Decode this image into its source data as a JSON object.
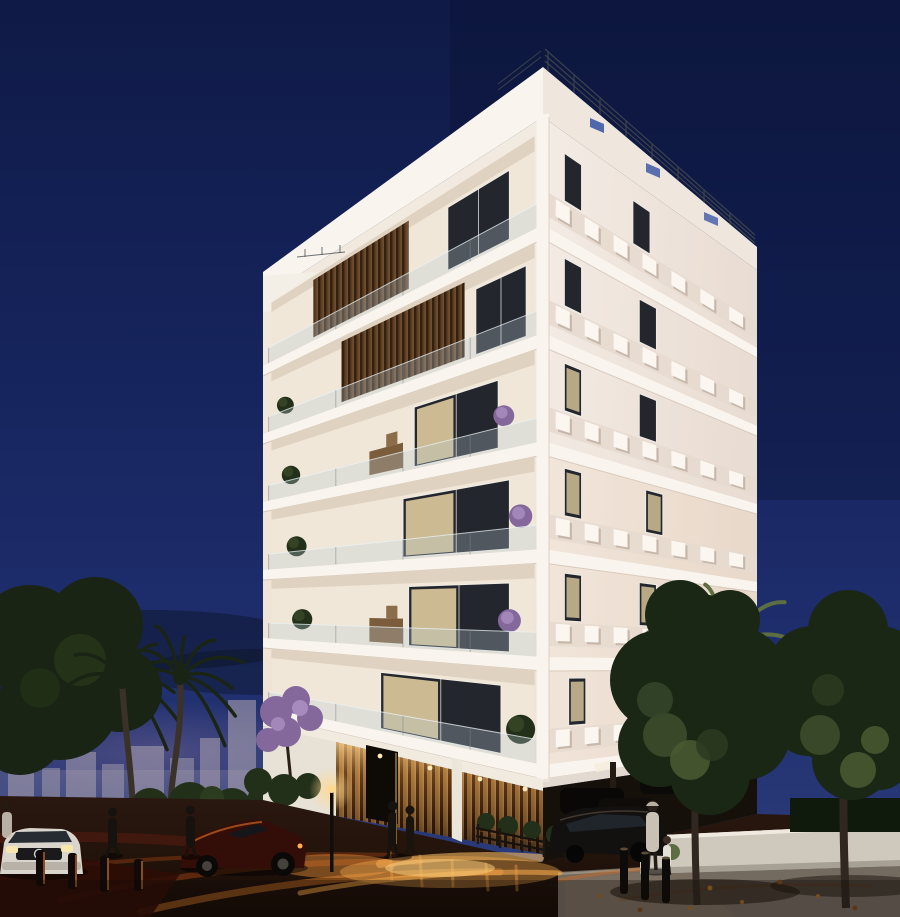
{
  "image": {
    "type": "3d-architectural-night-rendering",
    "subject": "modern white corner apartment building at dusk with lit balconies, palm trees, street life and warm street-light reflections"
  },
  "palette": {
    "sky_top": "#0f1a46",
    "sky_mid": "#16245d",
    "sky_low": "#1f2e6e",
    "sky_horizon": "#2e3e7c",
    "cloud_dark": "#0a1424",
    "horizon_glow": "#7c6a94",
    "skyline_haze": "#b5aab4",
    "facade_left": "#f2ebe1",
    "facade_right_near": "#f3ece5",
    "facade_right_far": "#e9dcd2",
    "slab_white": "#f9f5ee",
    "balcony_interior": "#f0e7d8",
    "balcony_ceiling": "#dccdbb",
    "parapet_band": "#e6d9cf",
    "perf_square": "#fbf7f0",
    "window_dark": "#23262d",
    "window_lit": "#e9d5a4",
    "window_frame": "#efece5",
    "wood_dark": "#33200f",
    "wood_mid": "#5a3d24",
    "wood_light": "#7a5835",
    "lobby_wood": "#9a6c38",
    "glass_railing": "#bac9d5",
    "plant_dark": "#22301a",
    "plant_light": "#41542c",
    "purple_plant": "#84689c",
    "tree_dark": "#1b2715",
    "tree_mid": "#2c3b20",
    "tree_light": "#495a31",
    "palm_dark": "#1a2415",
    "palm_lit": "#5d6e42",
    "trunk": "#3a3129",
    "street_dark": "#1d110a",
    "street_maroon": "#2e0d06",
    "orange_deep": "#8f3c10",
    "orange_mid": "#cf6a22",
    "orange_bright": "#f0a445",
    "amber": "#ffd382",
    "lamp_light": "#ffd98f",
    "pavement": "#736a60",
    "wall_white": "#cfc8bd",
    "car_white": "#d9d4cc",
    "car_dark": "#131010",
    "car_red": "#330e08",
    "figure_dark": "#16120d",
    "coat_light": "#c9c1b4",
    "sky_glimpse": "#3d5aa6"
  },
  "building": {
    "floors_visible": 6,
    "has_roof_railing": true,
    "ground_floor": {
      "material": "lit-wood-slats",
      "entrance": true,
      "covered_parking": true
    },
    "left_floors": [
      {
        "doors": [
          [
            0.12,
            0.34,
            false
          ]
        ],
        "wood": [
          0.48,
          0.82
        ],
        "bush": null,
        "purple": null,
        "furniture": false
      },
      {
        "doors": [
          [
            0.06,
            0.24,
            false
          ]
        ],
        "wood": [
          0.28,
          0.72
        ],
        "bush": {
          "u": 0.92,
          "r": 13
        },
        "purple": null,
        "furniture": false
      },
      {
        "doors": [
          [
            0.16,
            0.46,
            true
          ]
        ],
        "wood": null,
        "bush": {
          "u": 0.9,
          "r": 14
        },
        "purple": {
          "u": 0.14,
          "r": 11
        },
        "furniture": true
      },
      {
        "doors": [
          [
            0.12,
            0.5,
            true
          ]
        ],
        "wood": null,
        "bush": {
          "u": 0.88,
          "r": 15
        },
        "purple": {
          "u": 0.08,
          "r": 12
        },
        "furniture": false
      },
      {
        "doors": [
          [
            0.12,
            0.48,
            true
          ]
        ],
        "wood": null,
        "bush": {
          "u": 0.86,
          "r": 15
        },
        "purple": {
          "u": 0.12,
          "r": 12
        },
        "furniture": true
      },
      {
        "doors": [
          [
            0.15,
            0.58,
            true
          ]
        ],
        "wood": null,
        "bush": {
          "u": 0.08,
          "r": 15
        },
        "purple": null,
        "furniture": false
      }
    ],
    "right_floors": [
      {
        "windows": [
          [
            0.1,
            0.18,
            false
          ],
          [
            0.42,
            0.5,
            false
          ]
        ],
        "perforations": 7
      },
      {
        "windows": [
          [
            0.1,
            0.18,
            false
          ],
          [
            0.45,
            0.53,
            false
          ]
        ],
        "perforations": 7
      },
      {
        "windows": [
          [
            0.1,
            0.18,
            true
          ],
          [
            0.45,
            0.53,
            false
          ]
        ],
        "perforations": 7
      },
      {
        "windows": [
          [
            0.1,
            0.18,
            true
          ],
          [
            0.48,
            0.56,
            true
          ]
        ],
        "perforations": 7
      },
      {
        "windows": [
          [
            0.1,
            0.18,
            true
          ],
          [
            0.45,
            0.53,
            true
          ]
        ],
        "perforations": 7
      },
      {
        "windows": [
          [
            0.12,
            0.2,
            true
          ],
          [
            0.5,
            0.58,
            true
          ]
        ],
        "perforations": 7
      }
    ]
  },
  "scene": {
    "left_side": [
      "hazy-city-skyline",
      "two-palm-trees",
      "dark-foreground-tree",
      "white-planter-wall",
      "white-car",
      "dark-red-sports-car",
      "two-pedestrians"
    ],
    "right_side": [
      "two-street-trees",
      "lit-palm-fronds",
      "white-boundary-wall",
      "three-bollards",
      "woman-with-child",
      "dark-parked-cars"
    ],
    "street": [
      "warm-orange-light-reflections",
      "street-lamp",
      "metal-fence",
      "entrance-couple",
      "fallen-leaves"
    ]
  }
}
